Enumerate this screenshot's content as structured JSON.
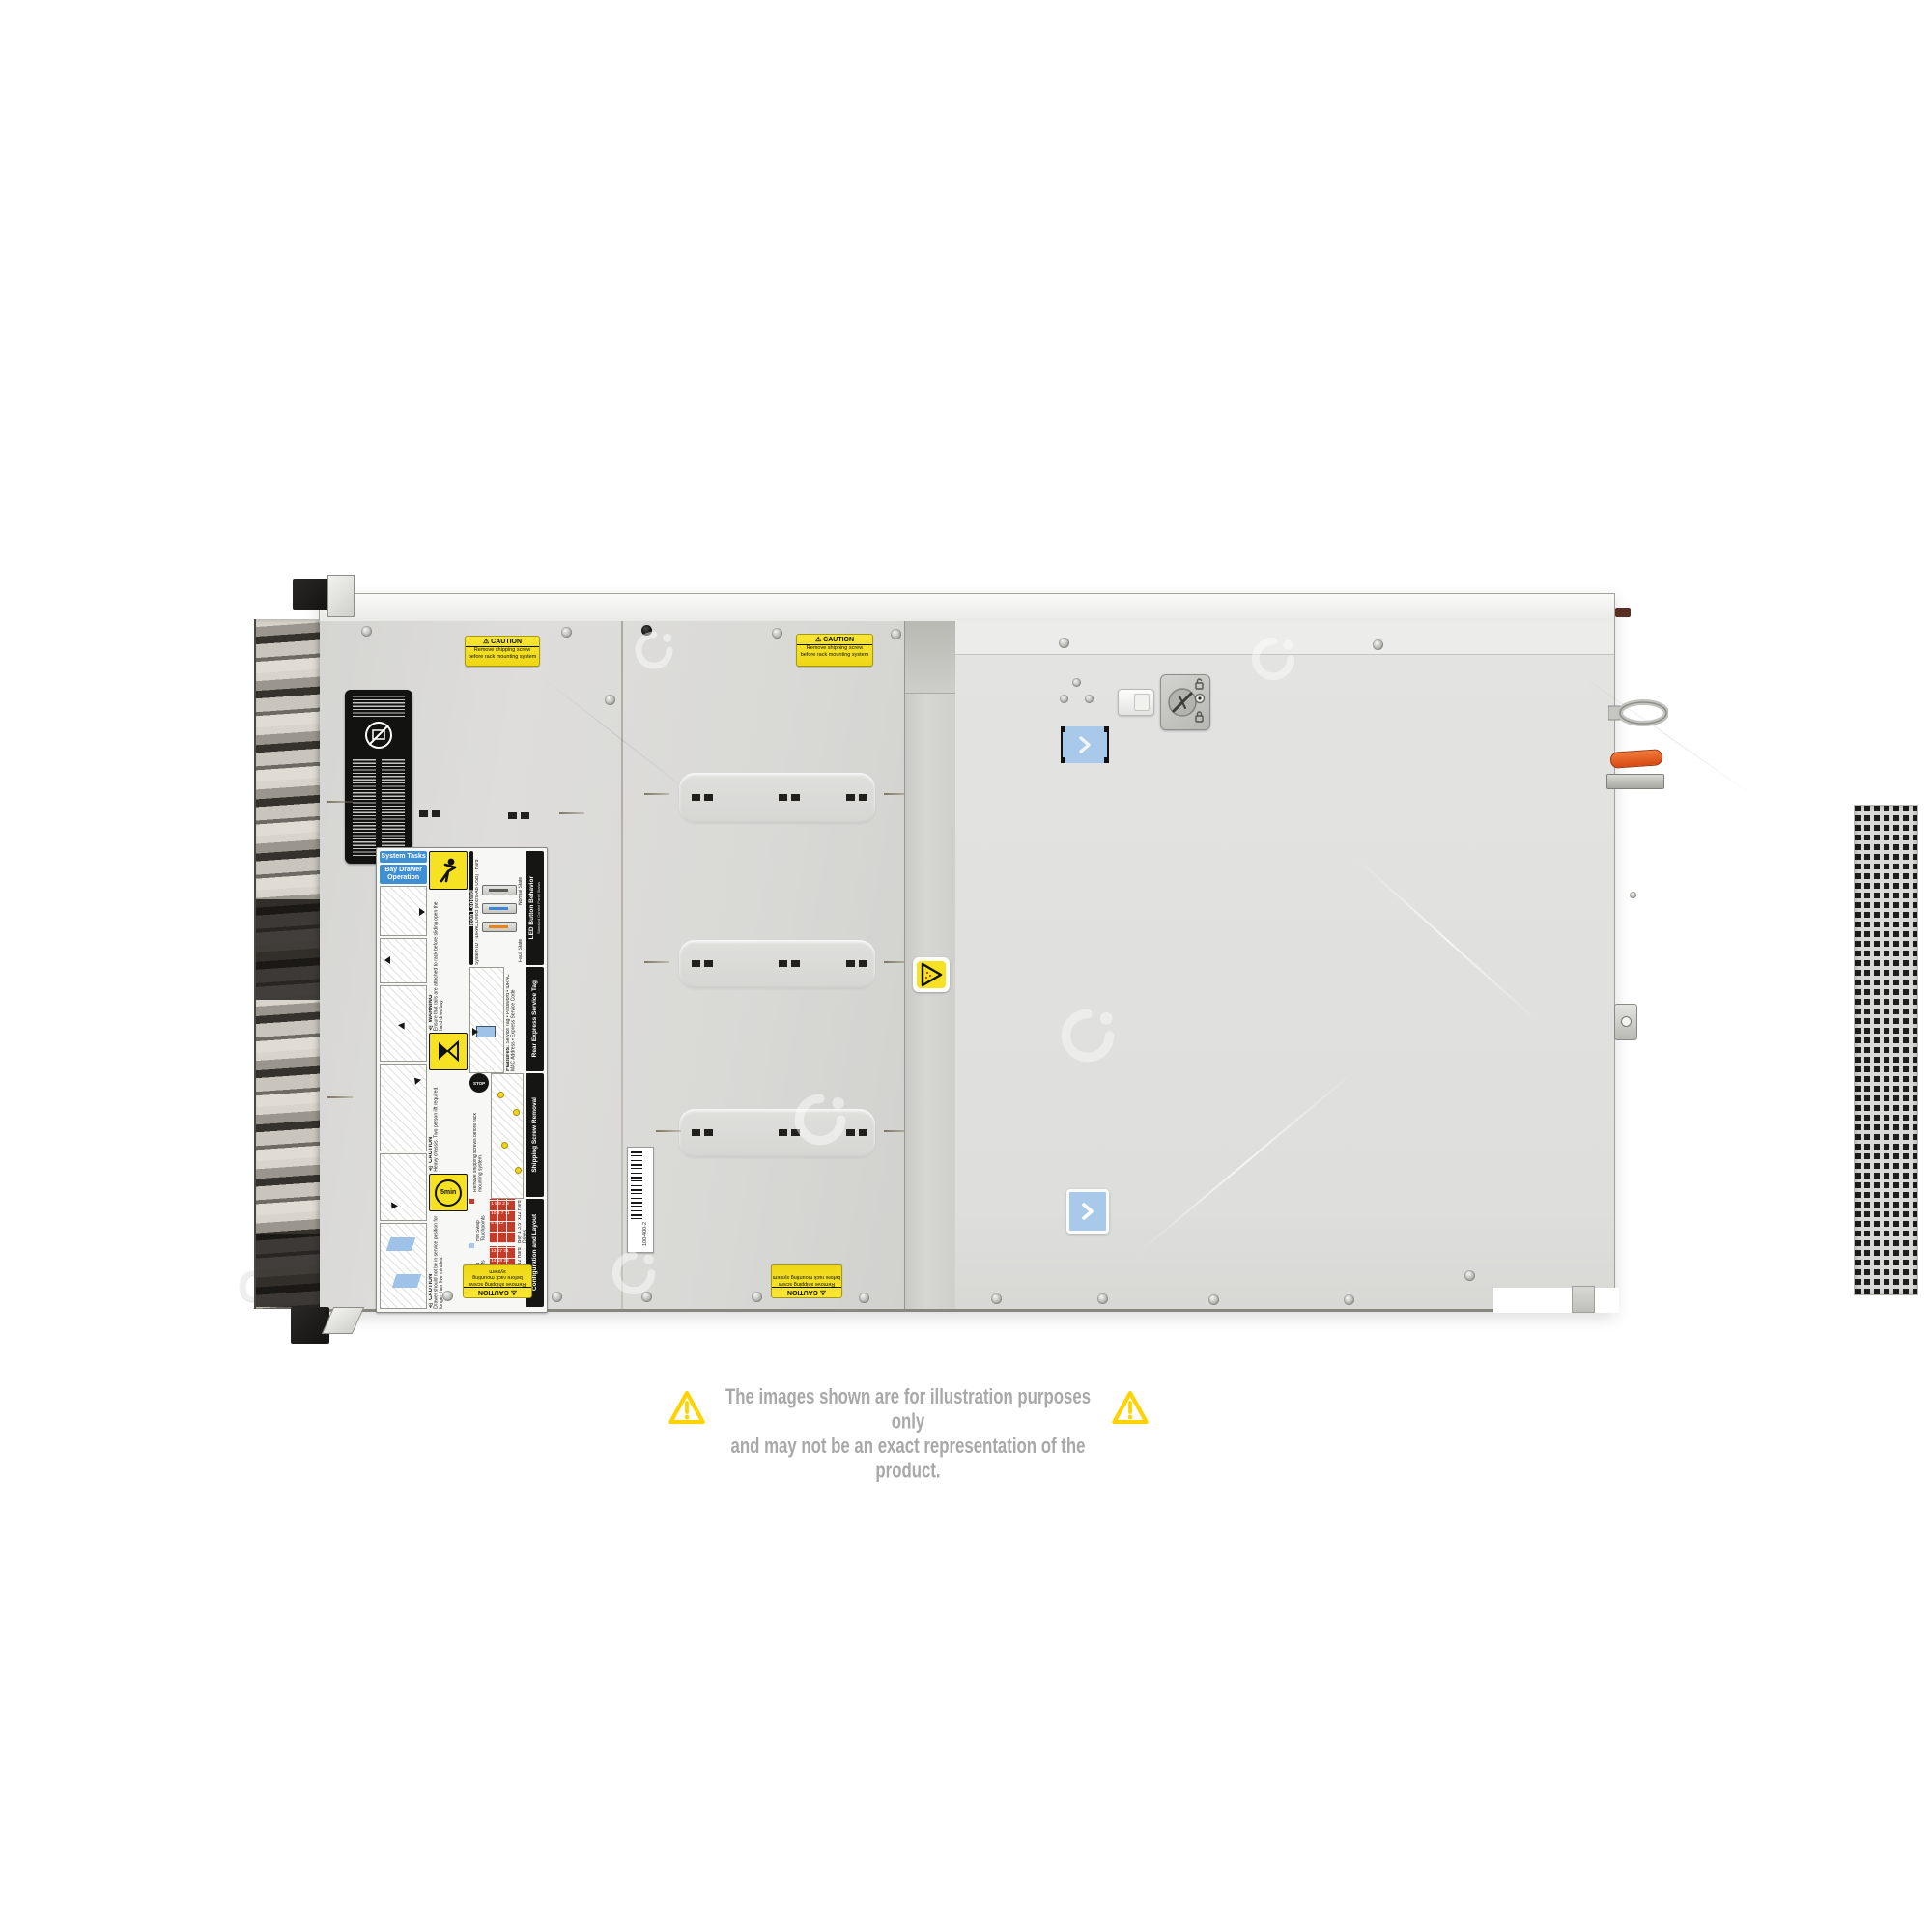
{
  "watermark": {
    "text": "COMPAN"
  },
  "disclaimer": {
    "line1": "The images shown are for illustration purposes only",
    "line2": "and may not be an exact representation of the product.",
    "text_color": "#a8a8a8",
    "warning_triangle_color": "#ffd200"
  },
  "chassis": {
    "caution_sticker": {
      "title": "CAUTION",
      "line1": "Remove shipping screw",
      "line2": "before rack mounting system",
      "bg_color": "#f2df1d"
    },
    "barcode_label": {
      "value": "100-400-2"
    },
    "touchpoints": {
      "color": "#a9c9ea"
    },
    "handle_color": "#e2551c",
    "service_label": {
      "chips": [
        "System Tasks",
        "Bay Drawer Operation"
      ],
      "icon_legend": {
        "title": "Icon Legend",
        "items": [
          "System ID",
          "iDRAC Direct (Micro-AB USB)",
          "Hard Drive Activity"
        ]
      },
      "led": {
        "title": "LED Button Behavior",
        "subtitle": "Standard Control Panel Status",
        "states": [
          "Normal State",
          "Fault State"
        ]
      },
      "service_tag": {
        "title": "Rear Express Service Tag",
        "features_heading": "Features:",
        "features": [
          "Service Tag",
          "Password",
          "iDRAC MAC Address",
          "Express Service Code"
        ]
      },
      "shipping": {
        "title": "Shipping Screw Removal",
        "stop_text": "STOP",
        "note": "Remove shipping screws before rack mounting system."
      },
      "config": {
        "title": "Configuration and Layout",
        "legend": [
          {
            "label": "Hot Swap Touchpoints",
            "color": "#c43b2a"
          },
          {
            "label": "Cold Swap Touchpoints",
            "color": "#a9c9ea"
          }
        ],
        "bays": [
          {
            "label": "Bay 1 3.5\" x12 Hard Drives",
            "numbers": [
              1,
              5,
              9,
              2,
              6,
              10,
              3,
              7,
              11,
              4,
              8,
              12
            ]
          },
          {
            "label": "Bay 2 3.5\" x12 Hard Drives",
            "numbers": [
              13,
              17,
              21,
              14,
              18,
              22,
              15,
              19,
              23,
              16,
              20,
              24
            ]
          }
        ]
      },
      "warnings": [
        {
          "title": "WARNING",
          "text": "Ensure that rails are attached to rack before sliding open the hard drive bay."
        },
        {
          "title": "CAUTION",
          "text": "Heavy chassis. Two person lift required."
        },
        {
          "title": "CAUTION",
          "text": "Drawer should not be in service position for longer than five minutes."
        }
      ],
      "timer_badge": "5min"
    }
  }
}
